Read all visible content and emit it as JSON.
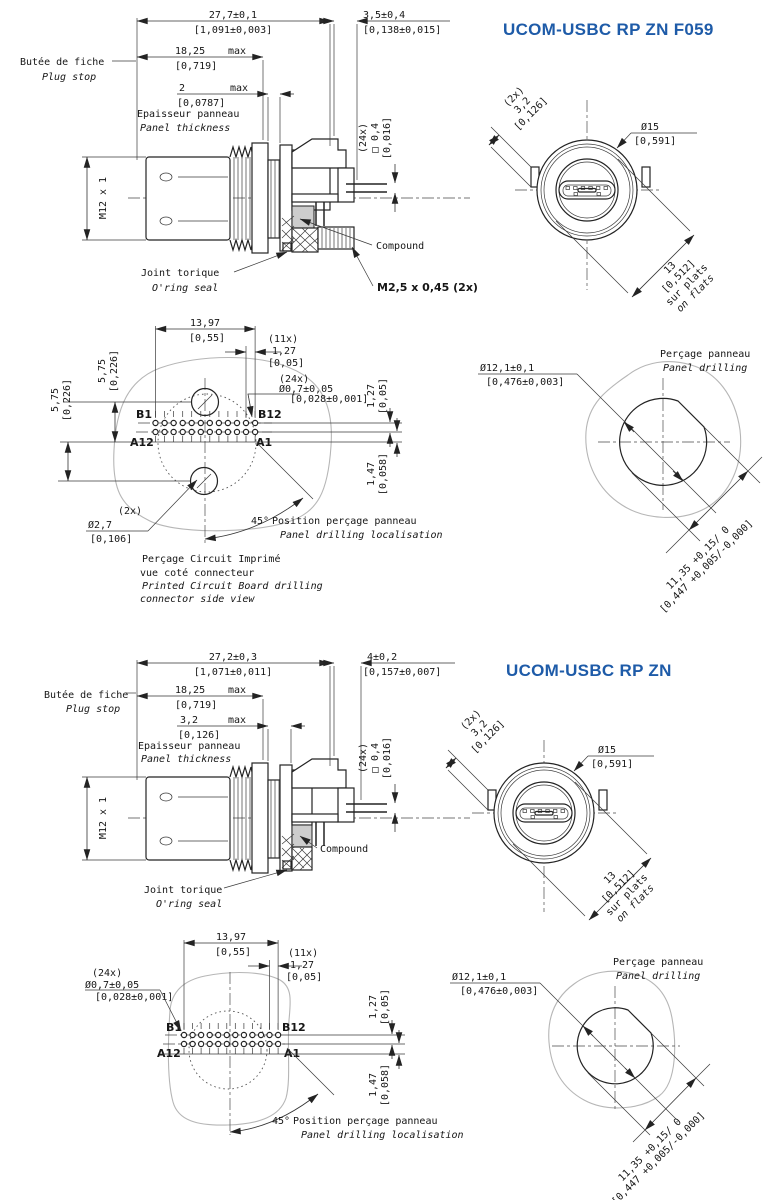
{
  "page": {
    "background": "#ffffff",
    "accent_color": "#1e5ba8"
  },
  "sections": [
    {
      "id": "f059",
      "title": "UCOM-USBC RP ZN F059",
      "side_view": {
        "dim_overall_mm": "27,7±0,1",
        "dim_overall_in": "[1,091±0,003]",
        "dim_tail_mm": "3,5±0,4",
        "dim_tail_in": "[0,138±0,015]",
        "plug_stop_fr": "Butée de fiche",
        "plug_stop_en": "Plug stop",
        "dim_depth_mm": "18,25",
        "dim_depth_max": "max",
        "dim_depth_in": "[0,719]",
        "dim_panel_mm": "2",
        "dim_panel_max": "max",
        "dim_panel_in": "[0,0787]",
        "panel_fr": "Epaisseur panneau",
        "panel_en": "Panel thickness",
        "thread_label": "M12 x 1",
        "pin_count": "(24x)",
        "pin_sq_mm": "□ 0,4",
        "pin_sq_in": "[0,016]",
        "compound_label": "Compound",
        "oring_fr": "Joint torique",
        "oring_en": "O'ring seal",
        "screw_label": "M2,5 x 0,45 (2x)"
      },
      "front_view": {
        "key_count": "(2x)",
        "key_mm": "3,2",
        "key_in": "[0,126]",
        "dia_mm": "Ø15",
        "dia_in": "[0,591]",
        "flats_mm": "13",
        "flats_in": "[0,512]",
        "flats_fr": "sur plats",
        "flats_en": "on flats"
      },
      "pcb_view": {
        "width_mm": "13,97",
        "width_in": "[0,55]",
        "pitch_count": "(11x)",
        "pitch_mm": "1,27",
        "pitch_in": "[0,05]",
        "up_mm": "5,75",
        "up_in": "[0,226]",
        "down_mm": "5,75",
        "down_in": "[0,226]",
        "hole_count": "(24x)",
        "hole_mm": "Ø0,7±0,05",
        "hole_in": "[0,028±0,001]",
        "b1": "B1",
        "b12": "B12",
        "a12": "A12",
        "a1": "A1",
        "row_mm": "1,27",
        "row_in": "[0,05]",
        "offset_mm": "1,47",
        "offset_in": "[0,058]",
        "big_count": "(2x)",
        "big_mm": "Ø2,7",
        "big_in": "[0,106]",
        "angle": "45°",
        "angle_fr": "Position perçage panneau",
        "angle_en": "Panel drilling localisation",
        "cap_fr1": "Perçage Circuit Imprimé",
        "cap_fr2": "vue coté connecteur",
        "cap_en1": "Printed Circuit Board drilling",
        "cap_en2": "connector side view"
      },
      "panel_view": {
        "cap_fr": "Perçage panneau",
        "cap_en": "Panel drilling",
        "dia_mm": "Ø12,1±0,1",
        "dia_in": "[0,476±0,003]",
        "flat_mm": "11,35 +0,15/ 0",
        "flat_in": "[0,447 +0,005/-0,000]"
      }
    },
    {
      "id": "zn",
      "title": "UCOM-USBC RP ZN",
      "side_view": {
        "dim_overall_mm": "27,2±0,3",
        "dim_overall_in": "[1,071±0,011]",
        "dim_tail_mm": "4±0,2",
        "dim_tail_in": "[0,157±0,007]",
        "plug_stop_fr": "Butée de fiche",
        "plug_stop_en": "Plug stop",
        "dim_depth_mm": "18,25",
        "dim_depth_max": "max",
        "dim_depth_in": "[0,719]",
        "dim_panel_mm": "3,2",
        "dim_panel_max": "max",
        "dim_panel_in": "[0,126]",
        "panel_fr": "Epaisseur panneau",
        "panel_en": "Panel thickness",
        "thread_label": "M12 x 1",
        "pin_count": "(24x)",
        "pin_sq_mm": "□ 0,4",
        "pin_sq_in": "[0,016]",
        "compound_label": "Compound",
        "oring_fr": "Joint torique",
        "oring_en": "O'ring seal"
      },
      "front_view": {
        "key_count": "(2x)",
        "key_mm": "3,2",
        "key_in": "[0,126]",
        "dia_mm": "Ø15",
        "dia_in": "[0,591]",
        "flats_mm": "13",
        "flats_in": "[0,512]",
        "flats_fr": "sur plats",
        "flats_en": "on flats"
      },
      "pcb_view": {
        "width_mm": "13,97",
        "width_in": "[0,55]",
        "pitch_count": "(11x)",
        "pitch_mm": "1,27",
        "pitch_in": "[0,05]",
        "hole_count": "(24x)",
        "hole_mm": "Ø0,7±0,05",
        "hole_in": "[0,028±0,001]",
        "b1": "B1",
        "b12": "B12",
        "a12": "A12",
        "a1": "A1",
        "row_mm": "1,27",
        "row_in": "[0,05]",
        "offset_mm": "1,47",
        "offset_in": "[0,058]",
        "angle": "45°",
        "angle_fr": "Position perçage panneau",
        "angle_en": "Panel drilling localisation"
      },
      "panel_view": {
        "cap_fr": "Perçage panneau",
        "cap_en": "Panel drilling",
        "dia_mm": "Ø12,1±0,1",
        "dia_in": "[0,476±0,003]",
        "flat_mm": "11,35 +0,15/ 0",
        "flat_in": "[0,447 +0,005/-0,000]"
      }
    }
  ]
}
